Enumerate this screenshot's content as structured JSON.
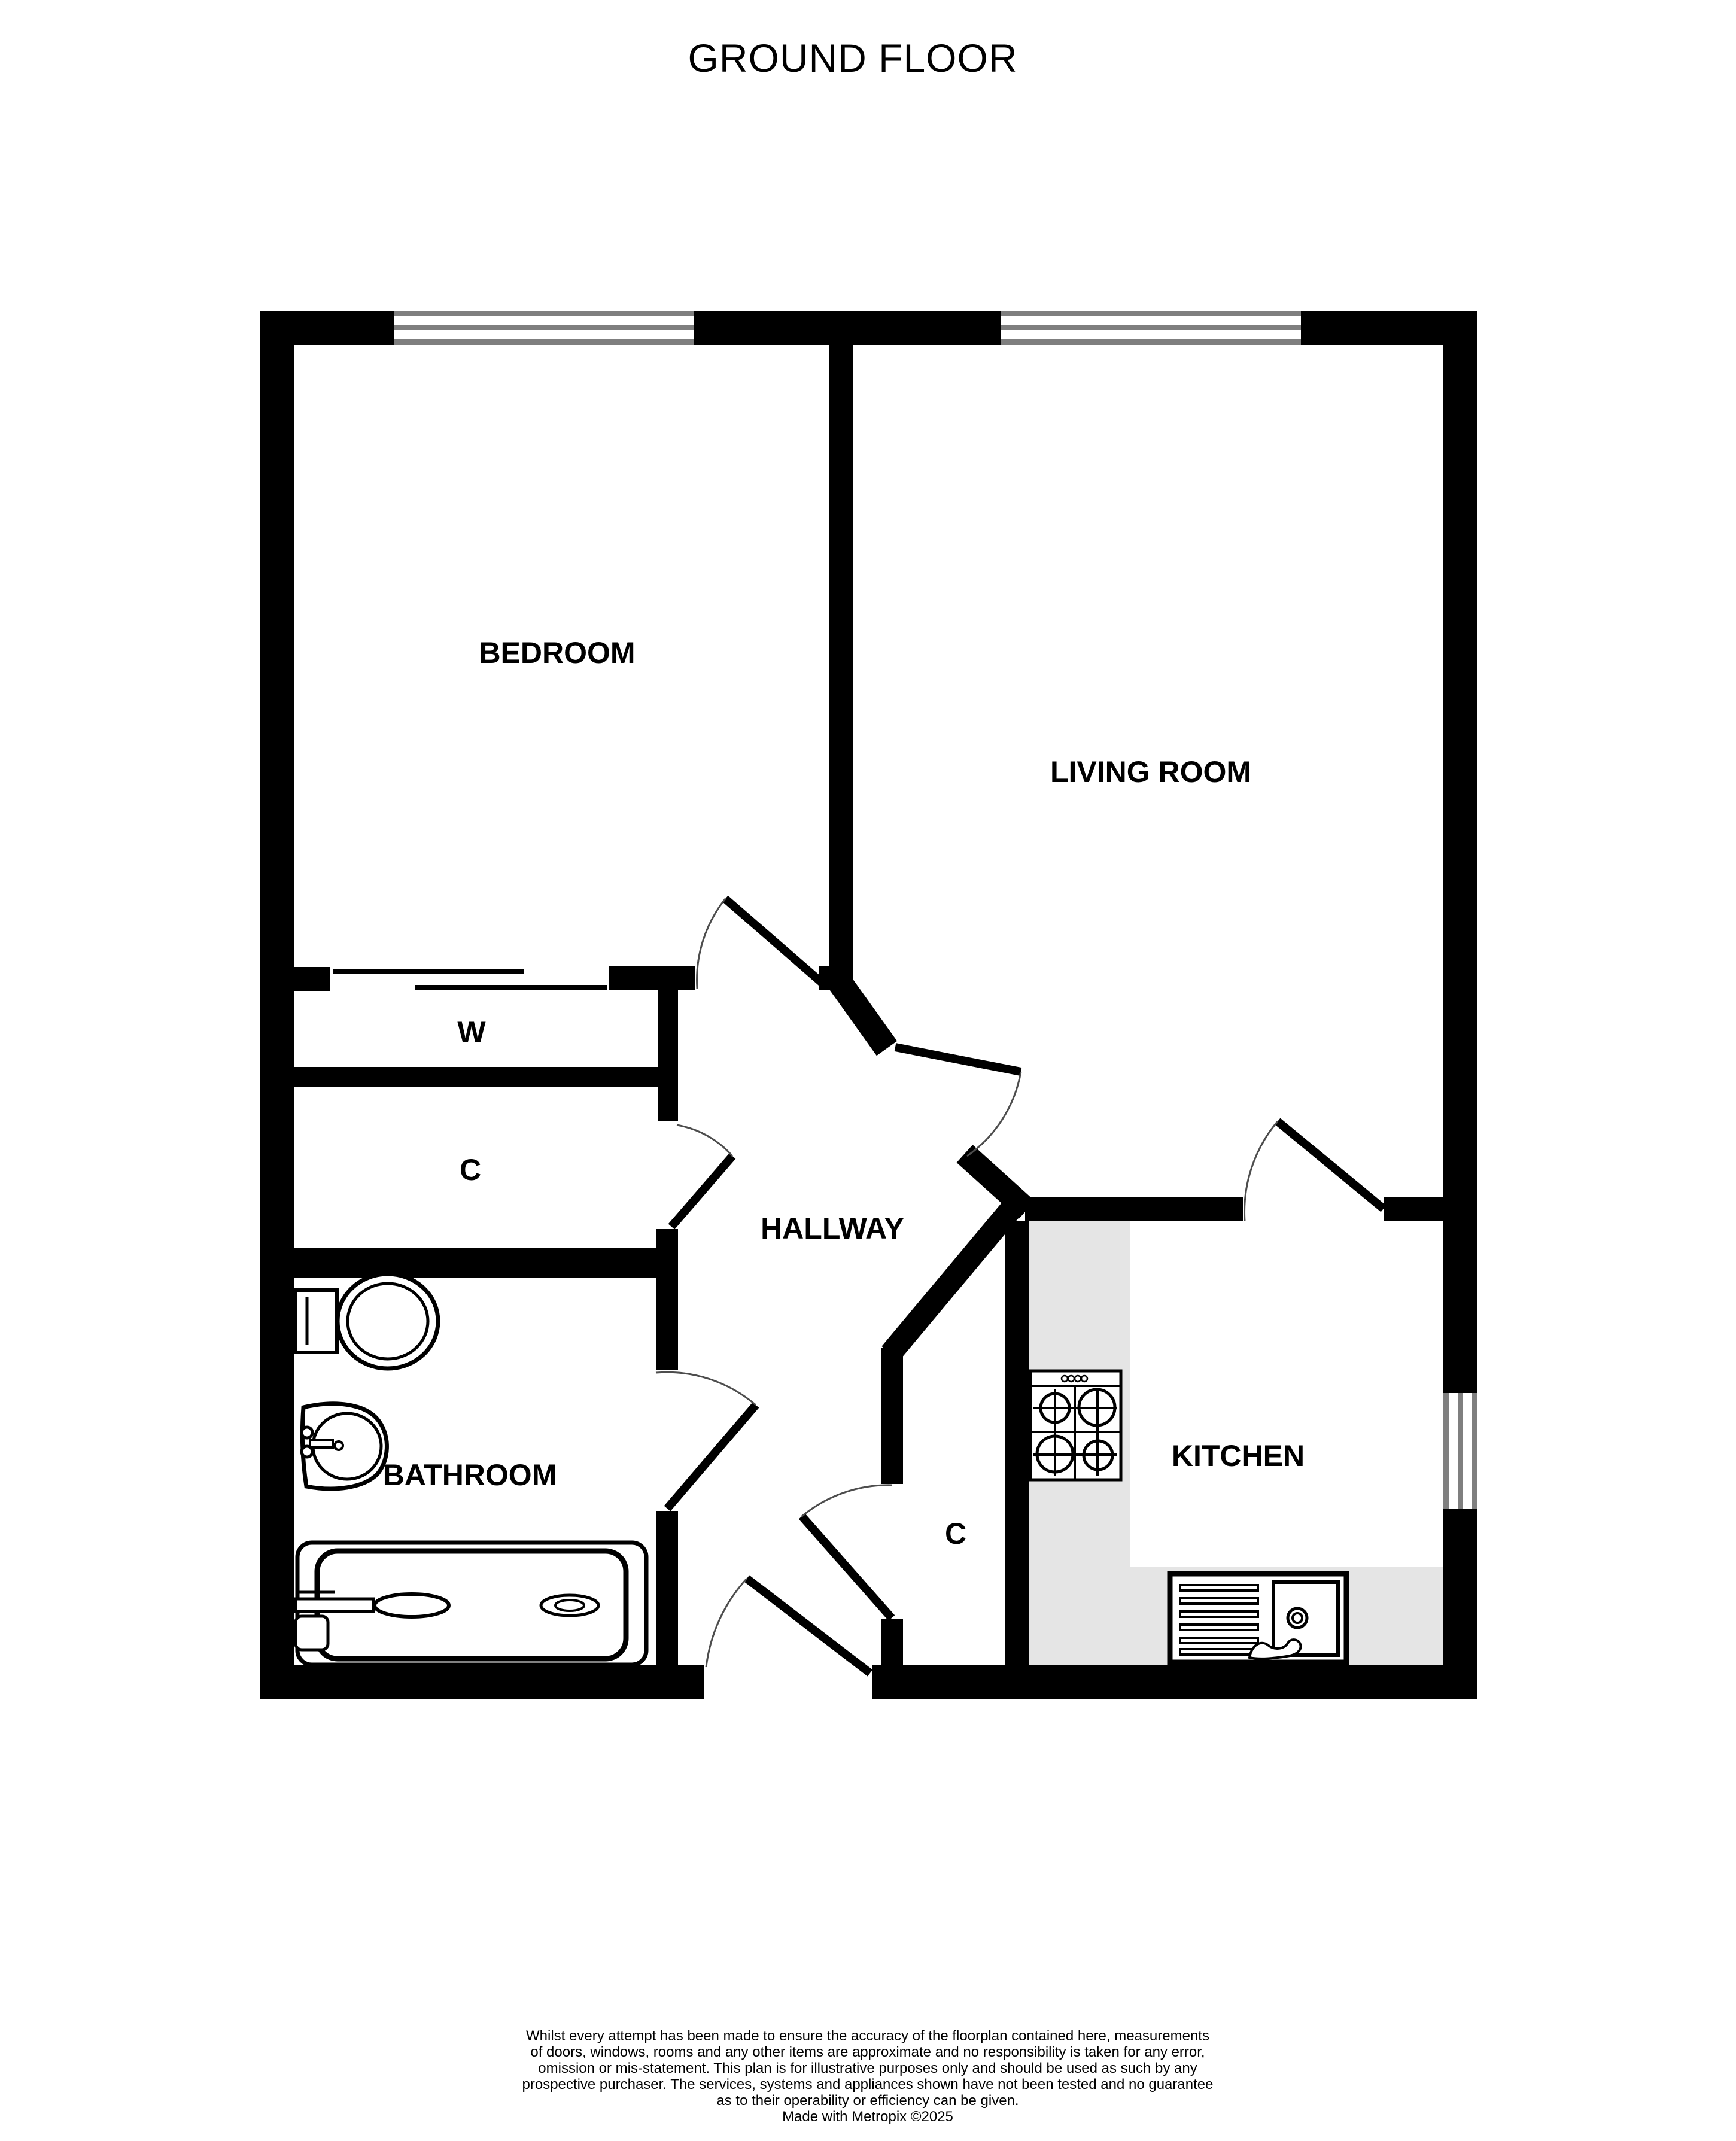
{
  "title": "GROUND FLOOR",
  "colors": {
    "wall": "#000000",
    "window_line": "#7f7f7f",
    "door_arc": "#4d4d4d",
    "counter": "#e5e5e5",
    "background": "#ffffff",
    "text": "#000000"
  },
  "rooms": [
    {
      "id": "bedroom",
      "label": "BEDROOM"
    },
    {
      "id": "living-room",
      "label": "LIVING ROOM"
    },
    {
      "id": "hallway",
      "label": "HALLWAY"
    },
    {
      "id": "wardrobe",
      "label": "W"
    },
    {
      "id": "cupboard-hall",
      "label": "C"
    },
    {
      "id": "bathroom",
      "label": "BATHROOM"
    },
    {
      "id": "cupboard-kitchen",
      "label": "C"
    },
    {
      "id": "kitchen",
      "label": "KITCHEN"
    }
  ],
  "fixtures": [
    "toilet",
    "wash-basin",
    "bath",
    "cooker-hob",
    "kitchen-sink-drainer"
  ],
  "windows": [
    "bedroom-window",
    "living-room-window",
    "kitchen-window"
  ],
  "footer": {
    "lines": [
      "Whilst every attempt has been made to ensure the accuracy of the floorplan contained here, measurements",
      "of doors, windows, rooms and any other items are approximate and no responsibility is taken for any error,",
      "omission or mis-statement. This plan is for illustrative purposes only and should be used as such by any",
      "prospective purchaser. The services, systems and appliances shown have not been tested and no guarantee",
      "as to their operability or efficiency can be given.",
      "Made with Metropix ©2025"
    ]
  }
}
